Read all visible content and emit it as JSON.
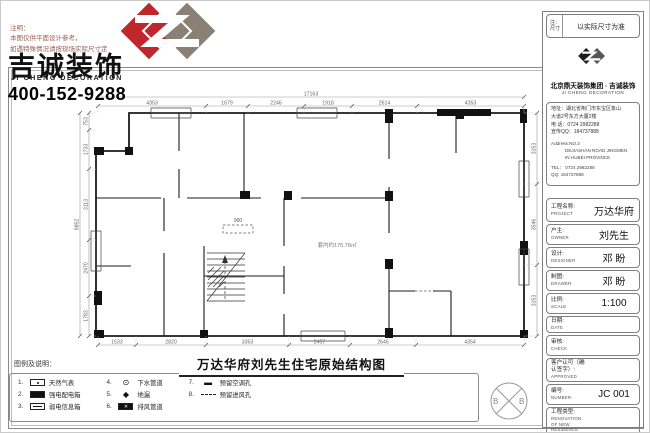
{
  "colors": {
    "accent_red": "#c0272d",
    "logo_gray": "#8a8075",
    "line_dark": "#1b1b1b",
    "dim_gray": "#666666"
  },
  "brand": {
    "note_lines": [
      "注明：",
      "本图仅供平面设计参考，",
      "如遇特殊情况请按现场实际尺寸定"
    ],
    "name_cn": "吉诚装饰",
    "name_en": "JI CHENG DECORATION",
    "phone": "400-152-9288"
  },
  "plan": {
    "title": "万达华府刘先生住宅原始结构图",
    "area_label": "套内约175.78㎡",
    "opening_label": "900",
    "dims": {
      "top_overall": "17163",
      "top": [
        "4353",
        "1679",
        "2246",
        "1918",
        "2614",
        "4353"
      ],
      "bottom": [
        "1533",
        "2820",
        "3353",
        "2457",
        "2646",
        "4354"
      ],
      "left_overall": "9852",
      "left": [
        "753",
        "1733",
        "3113",
        "2470",
        "1783"
      ],
      "right": [
        "3153",
        "3546",
        "3153"
      ]
    }
  },
  "legend": {
    "title": "图例及说明：",
    "items": [
      {
        "no": "1.",
        "symbol": "gas-meter",
        "label": "天然气表"
      },
      {
        "no": "2.",
        "symbol": "power-box",
        "label": "强电配电箱"
      },
      {
        "no": "3.",
        "symbol": "info-box",
        "label": "弱电信息箱"
      },
      {
        "no": "4.",
        "symbol": "drain-pipe",
        "label": "下水管道"
      },
      {
        "no": "5.",
        "symbol": "floor-drain",
        "label": "地漏"
      },
      {
        "no": "6.",
        "symbol": "exhaust-duct",
        "label": "排风管道"
      },
      {
        "no": "7.",
        "symbol": "ac-hole",
        "label": "预留空调孔"
      },
      {
        "no": "8.",
        "symbol": "air-inlet",
        "label": "预留进风孔"
      }
    ]
  },
  "stamp": {
    "left": "B",
    "right": "B"
  },
  "titleblock": {
    "note_label": "注：",
    "note_label2": "尺寸",
    "note_value": "以实际尺寸为准",
    "company": "北京鼎天装饰集团 · 吉诚装饰",
    "company_en": "JI CHENG DECORATION",
    "address_cn": [
      "地址：湖北省荆门市东宝区象山",
      "大道2号东方大厦2楼",
      "电 话：0724 2982288",
      "宣传QQ：184737888"
    ],
    "address_en": [
      "Address:NO.2",
      "DEJIASHAN ROAD JINGMEN",
      "IN HUBEI PROVINCE",
      "TEL： 0724 2982288",
      "QQ: 184737888"
    ],
    "fields": [
      {
        "label": "工程名称:",
        "sub": "PROJECT",
        "value": "万达华府"
      },
      {
        "label": "户主:",
        "sub": "OWNER",
        "value": "刘先生"
      },
      {
        "label": "设计:",
        "sub": "DESIGNER",
        "value": "邓 盼"
      },
      {
        "label": "制图:",
        "sub": "DRAWER",
        "value": "邓 盼"
      },
      {
        "label": "比例:",
        "sub": "SCALE",
        "value": "1:100"
      },
      {
        "label": "日期:",
        "sub": "DATE",
        "value": ""
      },
      {
        "label": "审核:",
        "sub": "CHECK",
        "value": ""
      },
      {
        "label": "客户认可（确认签字）:",
        "sub": "APPROVED",
        "value": ""
      },
      {
        "label": "编号:",
        "sub": "NUMBER",
        "value": "JC 001"
      },
      {
        "label": "工程类型:",
        "sub": "RENOVATION OF NEW RESIDENCE",
        "value": ""
      }
    ]
  }
}
